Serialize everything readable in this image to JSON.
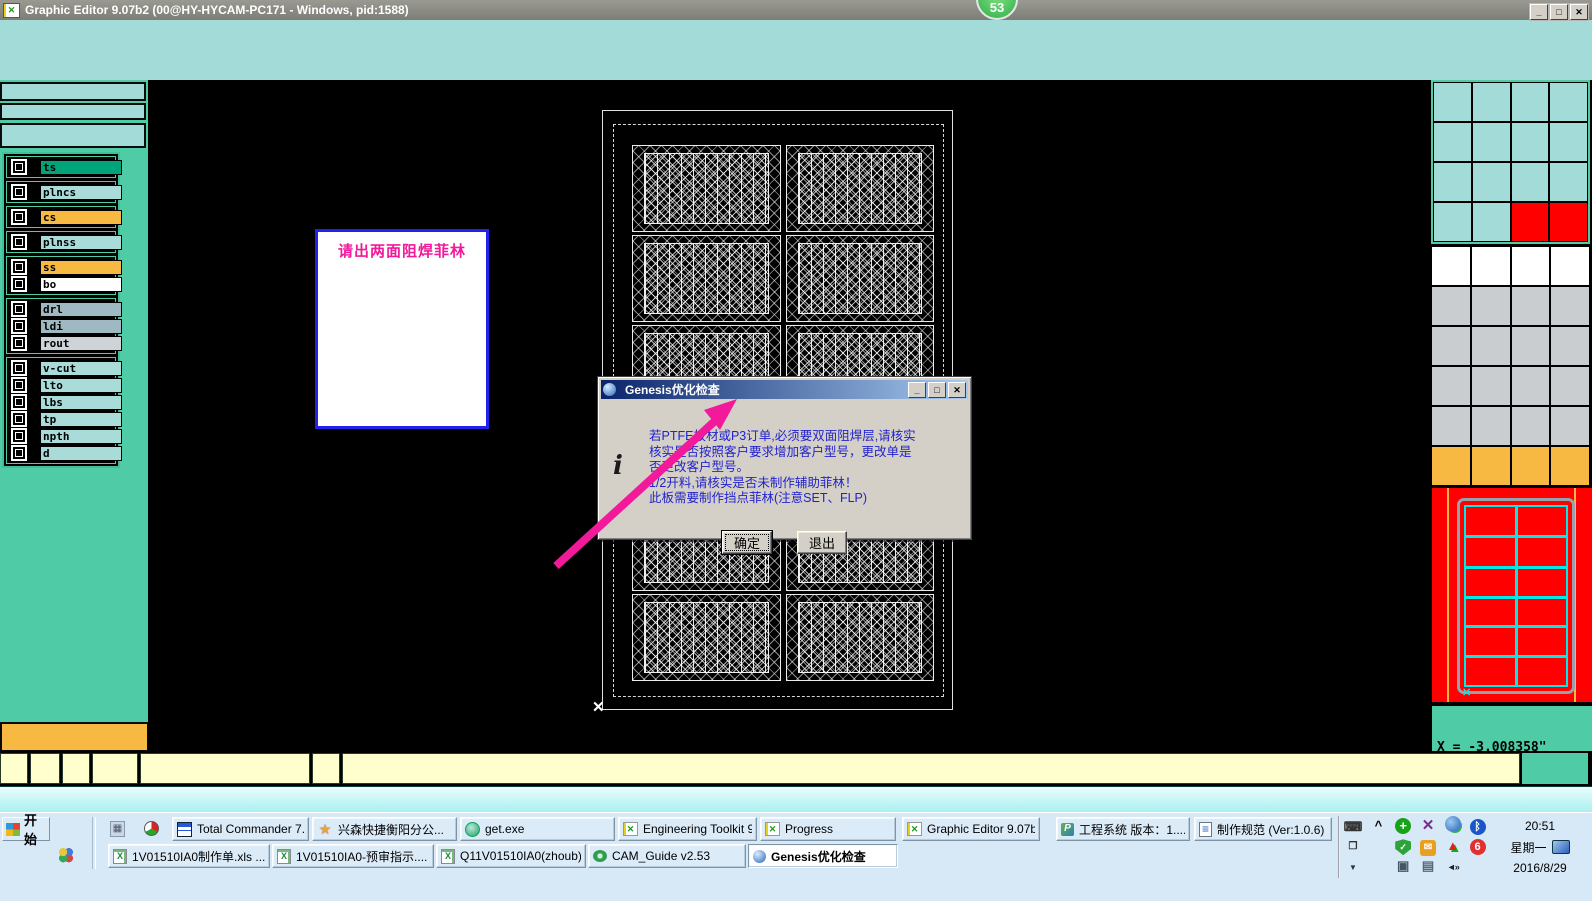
{
  "window": {
    "title": "Graphic Editor 9.07b2 (00@HY-HYCAM-PC171 - Windows, pid:1588)",
    "controls": [
      "minimize",
      "maximize",
      "close"
    ]
  },
  "overlay_badge": "53",
  "layer_panel": {
    "groups": [
      [
        {
          "name": "ts",
          "color": "#00a478"
        }
      ],
      [
        {
          "name": "plncs",
          "color": "#a9dbd9"
        }
      ],
      [
        {
          "name": "cs",
          "color": "#f7b942"
        }
      ],
      [
        {
          "name": "plnss",
          "color": "#a9dbd9"
        }
      ],
      [
        {
          "name": "ss",
          "color": "#f7b942"
        },
        {
          "name": "bo",
          "color": "#ffffff"
        }
      ],
      [
        {
          "name": "drl",
          "color": "#9fb9c2"
        },
        {
          "name": "ldi",
          "color": "#9fb9c2"
        },
        {
          "name": "rout",
          "color": "#cdd3d6"
        }
      ],
      [
        {
          "name": "v-cut",
          "color": "#a9dbd9"
        },
        {
          "name": "lto",
          "color": "#a9dbd9"
        },
        {
          "name": "lbs",
          "color": "#a9dbd9"
        },
        {
          "name": "tp",
          "color": "#a9dbd9"
        },
        {
          "name": "npth",
          "color": "#a9dbd9"
        },
        {
          "name": "d",
          "color": "#a9dbd9"
        }
      ]
    ]
  },
  "note": {
    "text": "请出两面阻焊菲林",
    "text_color": "#f2199a",
    "border_color": "#2222ee"
  },
  "drawing": {
    "rows": 6,
    "cols": 2
  },
  "dialog": {
    "title": "Genesis优化检查",
    "icon": "globe-icon",
    "message_lines": [
      "若PTFE板材或P3订单,必须要双面阻焊层,请核实",
      "核实是否按照客户要求增加客户型号，更改单是",
      "否更改客户型号。",
      "1/2开料,请核实是否未制作辅助菲林！",
      "此板需要制作挡点菲林(注意SET、FLP)"
    ],
    "text_color": "#2222cc",
    "ok_label": "确定",
    "exit_label": "退出"
  },
  "coords": {
    "x": "X = -3.008358\"",
    "y": "Y = 13.812537\""
  },
  "right_grid": {
    "colors": {
      "t": "#a3dbd8",
      "r": "#ff0000",
      "w": "#ffffff",
      "g": "#c9cdd0",
      "o": "#f7b942"
    },
    "teal_rows": [
      "tttt",
      "tttt",
      "tttt",
      "ttrr"
    ],
    "lower_rows": [
      "wwww",
      "gggg",
      "gggg",
      "gggg",
      "gggg",
      "oooo"
    ]
  },
  "status_segments": [
    {
      "w": 28
    },
    {
      "w": 30
    },
    {
      "w": 28
    },
    {
      "w": 46
    },
    {
      "w": 170
    },
    {
      "w": 28
    },
    {
      "w": 1178
    },
    {
      "w": 66,
      "color": "#4fcba5"
    }
  ],
  "taskbar": {
    "start_label": "开始",
    "row1": [
      {
        "label": "Total Commander 7.0 ...",
        "icon": "floppy",
        "x": 172,
        "w": 137
      },
      {
        "label": "兴森快捷衡阳分公...",
        "icon": "star",
        "x": 312,
        "w": 145
      },
      {
        "label": "get.exe",
        "icon": "globe",
        "x": 460,
        "w": 155
      },
      {
        "label": "Engineering Toolkit 9....",
        "icon": "gx",
        "x": 618,
        "w": 139
      },
      {
        "label": "Progress",
        "icon": "gx",
        "x": 760,
        "w": 136
      },
      {
        "label": "Graphic Editor 9.07b2...",
        "icon": "gx",
        "x": 902,
        "w": 138
      },
      {
        "label": "工程系统  版本：1....",
        "icon": "p",
        "x": 1056,
        "w": 134
      },
      {
        "label": "制作规范 (Ver:1.0.6)",
        "icon": "doc",
        "x": 1194,
        "w": 138
      }
    ],
    "row2": [
      {
        "label": "1V01510IA0制作单.xls ...",
        "icon": "excel",
        "x": 108,
        "w": 162
      },
      {
        "label": "1V01510IA0-预审指示....",
        "icon": "excel",
        "x": 272,
        "w": 162
      },
      {
        "label": "Q11V01510IA0(zhoub).x...",
        "icon": "excel",
        "x": 436,
        "w": 150
      },
      {
        "label": "CAM_Guide v2.53",
        "icon": "cam",
        "x": 588,
        "w": 158
      },
      {
        "label": "Genesis优化检查",
        "icon": "globe2",
        "x": 748,
        "w": 150,
        "active": true
      }
    ],
    "tray": {
      "icon_rows": [
        [
          "chevron",
          "avplus",
          "xpurple",
          "blueglobe",
          "bluetooth"
        ],
        [
          "",
          "shield",
          "mailc",
          "redarrow",
          "six"
        ],
        [
          "",
          "netplug",
          "clipboard",
          "speaker",
          ""
        ]
      ],
      "time": "20:51",
      "day": "星期一",
      "date": "2016/8/29"
    }
  }
}
